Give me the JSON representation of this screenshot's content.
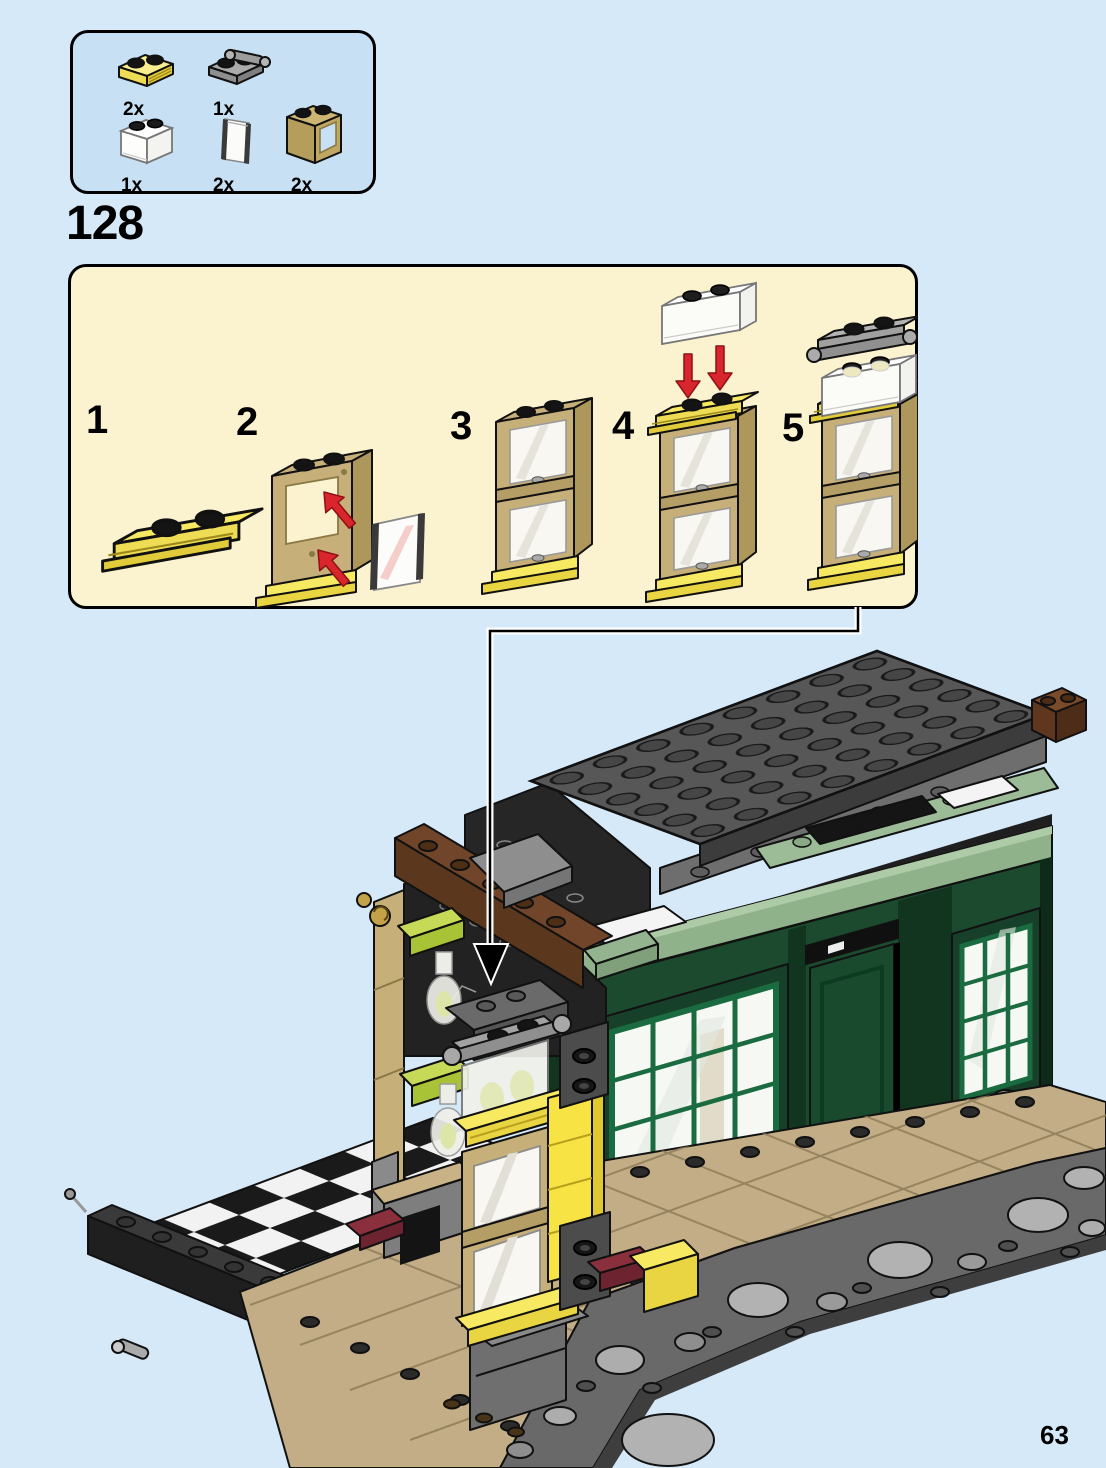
{
  "page": {
    "number": "63"
  },
  "parts_box": {
    "parts": [
      {
        "id": "plate-1x2-with-rail-yellow",
        "qty": "2x"
      },
      {
        "id": "plate-1x2-with-handle-gray",
        "qty": "1x"
      },
      {
        "id": "brick-1x2-trans-clear",
        "qty": "1x"
      },
      {
        "id": "glass-pane-trans-clear",
        "qty": "2x"
      },
      {
        "id": "window-frame-1x2x2-tan",
        "qty": "2x"
      }
    ]
  },
  "step": {
    "number": "128",
    "substeps": [
      {
        "label": "1"
      },
      {
        "label": "2"
      },
      {
        "label": "3"
      },
      {
        "label": "4"
      },
      {
        "label": "5"
      }
    ]
  },
  "colors": {
    "page_bg": "#D6E9F8",
    "parts_box_bg": "#C7E0F4",
    "step_panel_bg": "#FBF2CF",
    "arrow_red": "#D9252C",
    "plate_yellow": "#F8E963",
    "frame_tan": "#C6AF79",
    "plate_gray": "#A6A6A6",
    "building_dark_green": "#1C4A2E",
    "trim_sand_green": "#8FB28B",
    "roof_gray": "#575757",
    "ground_tan": "#C3AD86",
    "cobble_gray": "#B2B2B2",
    "brick_brown": "#6B4026",
    "accent_lime": "#B8CE4A",
    "accent_dark_red": "#8A2F3C"
  }
}
